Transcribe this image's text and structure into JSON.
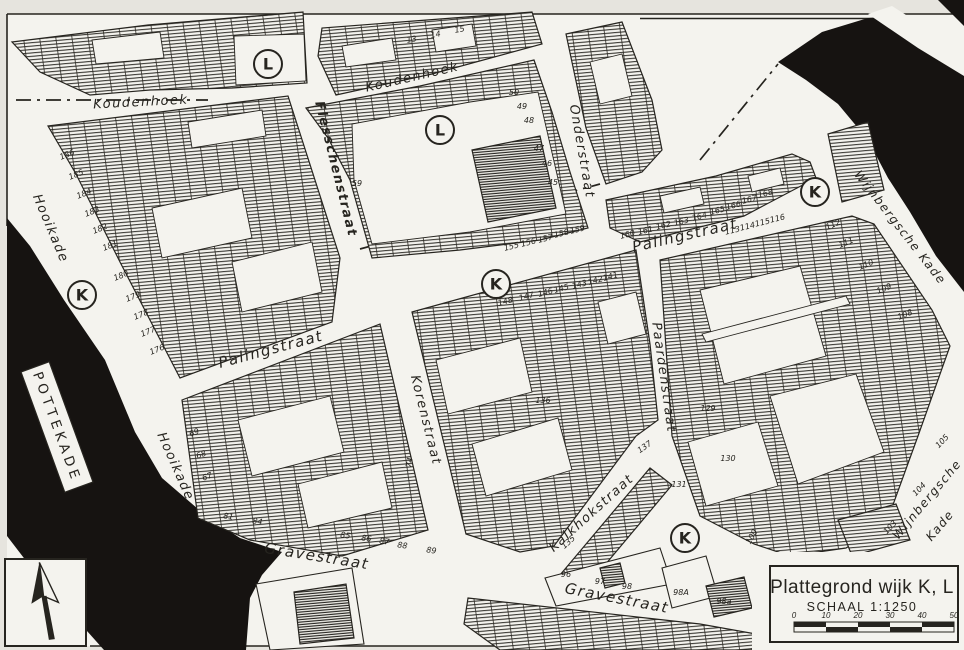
{
  "map": {
    "colors": {
      "paper": "#e6e4de",
      "field": "#f4f3ee",
      "ink": "#26241f",
      "water": "#161311"
    },
    "title_box": {
      "title": "Plattegrond wijk K, L",
      "scale_label": "SCHAAL 1:1250",
      "scale_ticks": [
        "0",
        "10",
        "20",
        "30",
        "40",
        "50"
      ]
    },
    "quay_plate": {
      "text": "POTTEKADE"
    },
    "district_markers": [
      {
        "letter": "L",
        "x": 268,
        "y": 64
      },
      {
        "letter": "L",
        "x": 440,
        "y": 130
      },
      {
        "letter": "K",
        "x": 82,
        "y": 295
      },
      {
        "letter": "K",
        "x": 496,
        "y": 284
      },
      {
        "letter": "K",
        "x": 815,
        "y": 192
      },
      {
        "letter": "K",
        "x": 685,
        "y": 538
      }
    ],
    "street_labels": [
      {
        "text": "Koudenhoek",
        "x": 141,
        "y": 106,
        "rot": -3,
        "size": 13
      },
      {
        "text": "Koudenhoek",
        "x": 413,
        "y": 81,
        "rot": -13,
        "size": 13
      },
      {
        "text": "Flesschenstraat",
        "x": 332,
        "y": 170,
        "rot": 76,
        "size": 13,
        "bold": true
      },
      {
        "text": "Onderstraat",
        "x": 578,
        "y": 152,
        "rot": 80,
        "size": 13
      },
      {
        "text": "Palingstraat",
        "x": 272,
        "y": 354,
        "rot": -15,
        "size": 15
      },
      {
        "text": "Palingstraat",
        "x": 686,
        "y": 240,
        "rot": -13,
        "size": 15
      },
      {
        "text": "Korenstraat",
        "x": 422,
        "y": 421,
        "rot": 76,
        "size": 13
      },
      {
        "text": "Paardenstraat",
        "x": 660,
        "y": 378,
        "rot": 82,
        "size": 13
      },
      {
        "text": "Hooikade",
        "x": 47,
        "y": 230,
        "rot": 67,
        "size": 13
      },
      {
        "text": "Hooikade",
        "x": 172,
        "y": 468,
        "rot": 66,
        "size": 13
      },
      {
        "text": "Kalkhokstraat",
        "x": 594,
        "y": 516,
        "rot": -42,
        "size": 13
      },
      {
        "text": "Gravestraat",
        "x": 316,
        "y": 561,
        "rot": 9,
        "size": 15
      },
      {
        "text": "Gravestraat",
        "x": 616,
        "y": 603,
        "rot": 11,
        "size": 15
      },
      {
        "text": "Wijnbergsche Kade",
        "x": 897,
        "y": 230,
        "rot": 52,
        "size": 12
      },
      {
        "text": "Wijnbergsche",
        "x": 930,
        "y": 502,
        "rot": -50,
        "size": 12
      },
      {
        "text": "Kade",
        "x": 943,
        "y": 528,
        "rot": -50,
        "size": 12
      }
    ],
    "parcel_numbers": [
      {
        "t": "13",
        "x": 412,
        "y": 42,
        "r": -10
      },
      {
        "t": "14",
        "x": 436,
        "y": 37,
        "r": -10
      },
      {
        "t": "15",
        "x": 460,
        "y": 32,
        "r": -10
      },
      {
        "t": "50",
        "x": 514,
        "y": 95,
        "r": 0
      },
      {
        "t": "49",
        "x": 522,
        "y": 109,
        "r": 0
      },
      {
        "t": "48",
        "x": 529,
        "y": 123,
        "r": 0
      },
      {
        "t": "47",
        "x": 539,
        "y": 151,
        "r": 0
      },
      {
        "t": "46",
        "x": 547,
        "y": 166,
        "r": 0
      },
      {
        "t": "45",
        "x": 553,
        "y": 185,
        "r": 0
      },
      {
        "t": "59",
        "x": 357,
        "y": 186,
        "r": 0
      },
      {
        "t": "186",
        "x": 68,
        "y": 157,
        "r": -22
      },
      {
        "t": "185",
        "x": 77,
        "y": 177,
        "r": -22
      },
      {
        "t": "184",
        "x": 85,
        "y": 196,
        "r": -22
      },
      {
        "t": "183",
        "x": 93,
        "y": 214,
        "r": -22
      },
      {
        "t": "182",
        "x": 101,
        "y": 231,
        "r": -22
      },
      {
        "t": "181",
        "x": 111,
        "y": 248,
        "r": -22
      },
      {
        "t": "180",
        "x": 122,
        "y": 278,
        "r": -22
      },
      {
        "t": "179",
        "x": 134,
        "y": 299,
        "r": -22
      },
      {
        "t": "178",
        "x": 142,
        "y": 317,
        "r": -22
      },
      {
        "t": "177",
        "x": 149,
        "y": 334,
        "r": -22
      },
      {
        "t": "176",
        "x": 158,
        "y": 352,
        "r": -22
      },
      {
        "t": "155",
        "x": 512,
        "y": 249,
        "r": -14
      },
      {
        "t": "156",
        "x": 529,
        "y": 245,
        "r": -14
      },
      {
        "t": "157",
        "x": 546,
        "y": 241,
        "r": -14
      },
      {
        "t": "158",
        "x": 562,
        "y": 236,
        "r": -14
      },
      {
        "t": "159",
        "x": 578,
        "y": 232,
        "r": -14
      },
      {
        "t": "160",
        "x": 628,
        "y": 237,
        "r": -14
      },
      {
        "t": "161",
        "x": 646,
        "y": 233,
        "r": -14
      },
      {
        "t": "162",
        "x": 664,
        "y": 228,
        "r": -14
      },
      {
        "t": "163",
        "x": 682,
        "y": 224,
        "r": -14
      },
      {
        "t": "164",
        "x": 700,
        "y": 219,
        "r": -14
      },
      {
        "t": "165",
        "x": 718,
        "y": 213,
        "r": -14
      },
      {
        "t": "166",
        "x": 734,
        "y": 208,
        "r": -14
      },
      {
        "t": "167",
        "x": 750,
        "y": 202,
        "r": -14
      },
      {
        "t": "168",
        "x": 766,
        "y": 196,
        "r": -14
      },
      {
        "t": "148",
        "x": 506,
        "y": 304,
        "r": -15
      },
      {
        "t": "147",
        "x": 527,
        "y": 299,
        "r": -15
      },
      {
        "t": "146",
        "x": 546,
        "y": 295,
        "r": -15
      },
      {
        "t": "145",
        "x": 562,
        "y": 291,
        "r": -15
      },
      {
        "t": "143",
        "x": 580,
        "y": 287,
        "r": -15
      },
      {
        "t": "142",
        "x": 596,
        "y": 283,
        "r": -15
      },
      {
        "t": "141",
        "x": 611,
        "y": 279,
        "r": -15
      },
      {
        "t": "136",
        "x": 543,
        "y": 403,
        "r": 0
      },
      {
        "t": "137",
        "x": 646,
        "y": 449,
        "r": -35
      },
      {
        "t": "135",
        "x": 570,
        "y": 544,
        "r": -42
      },
      {
        "t": "131",
        "x": 679,
        "y": 487,
        "r": 0
      },
      {
        "t": "96",
        "x": 566,
        "y": 577,
        "r": 0
      },
      {
        "t": "97",
        "x": 600,
        "y": 584,
        "r": 0
      },
      {
        "t": "98",
        "x": 627,
        "y": 589,
        "r": 0
      },
      {
        "t": "98A",
        "x": 681,
        "y": 595,
        "r": 0
      },
      {
        "t": "98a",
        "x": 724,
        "y": 604,
        "r": 0
      },
      {
        "t": "81",
        "x": 228,
        "y": 519,
        "r": 8
      },
      {
        "t": "84",
        "x": 257,
        "y": 524,
        "r": 8
      },
      {
        "t": "85",
        "x": 345,
        "y": 538,
        "r": 8
      },
      {
        "t": "86",
        "x": 366,
        "y": 541,
        "r": 8
      },
      {
        "t": "87",
        "x": 384,
        "y": 544,
        "r": 8
      },
      {
        "t": "88",
        "x": 402,
        "y": 548,
        "r": 8
      },
      {
        "t": "89",
        "x": 431,
        "y": 553,
        "r": 8
      },
      {
        "t": "69",
        "x": 195,
        "y": 435,
        "r": -20
      },
      {
        "t": "68",
        "x": 202,
        "y": 457,
        "r": -20
      },
      {
        "t": "67",
        "x": 208,
        "y": 479,
        "r": -20
      },
      {
        "t": "74",
        "x": 412,
        "y": 463,
        "r": -78
      },
      {
        "t": "112",
        "x": 834,
        "y": 227,
        "r": -22
      },
      {
        "t": "111",
        "x": 847,
        "y": 245,
        "r": -22
      },
      {
        "t": "110",
        "x": 867,
        "y": 267,
        "r": -22
      },
      {
        "t": "109",
        "x": 885,
        "y": 291,
        "r": -22
      },
      {
        "t": "108",
        "x": 906,
        "y": 317,
        "r": -22
      },
      {
        "t": "113",
        "x": 733,
        "y": 233,
        "r": -13
      },
      {
        "t": "114",
        "x": 748,
        "y": 229,
        "r": -13
      },
      {
        "t": "115",
        "x": 763,
        "y": 225,
        "r": -13
      },
      {
        "t": "116",
        "x": 778,
        "y": 221,
        "r": -13
      },
      {
        "t": "129",
        "x": 708,
        "y": 411,
        "r": 0
      },
      {
        "t": "130",
        "x": 728,
        "y": 461,
        "r": 0
      },
      {
        "t": "100",
        "x": 754,
        "y": 538,
        "r": -60
      },
      {
        "t": "105",
        "x": 944,
        "y": 443,
        "r": -46
      },
      {
        "t": "104",
        "x": 921,
        "y": 491,
        "r": -46
      },
      {
        "t": "103",
        "x": 892,
        "y": 529,
        "r": -46
      }
    ]
  }
}
